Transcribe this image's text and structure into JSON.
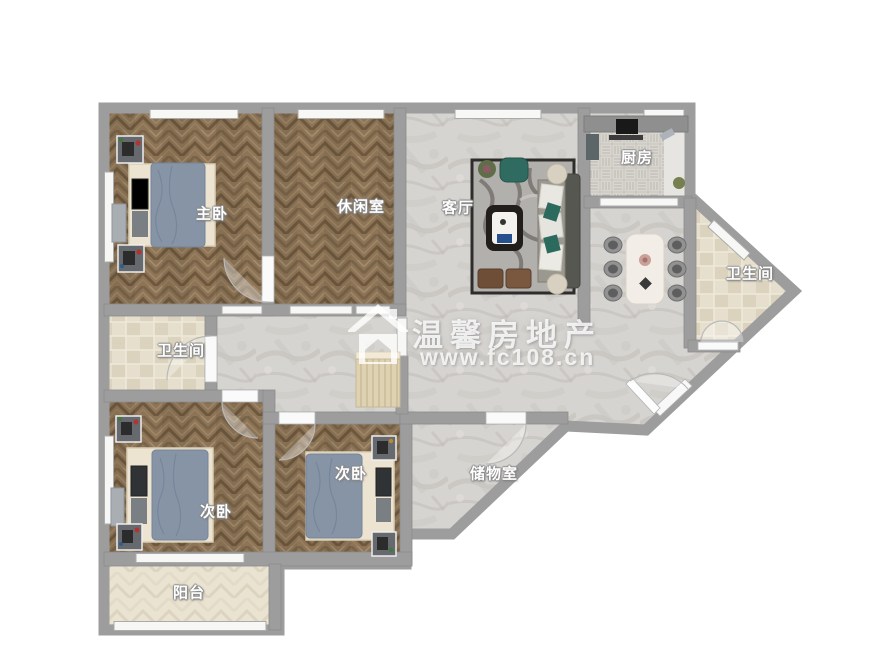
{
  "watermark": {
    "brand": "温馨房地产",
    "website": "www.fc108.cn",
    "logo_icon": "house-logo-icon"
  },
  "rooms": {
    "master_bedroom": {
      "label": "主卧"
    },
    "leisure_room": {
      "label": "休闲室"
    },
    "living_room": {
      "label": "客厅"
    },
    "kitchen": {
      "label": "厨房"
    },
    "bathroom_right": {
      "label": "卫生间"
    },
    "bathroom_left": {
      "label": "卫生间"
    },
    "second_bedroom_left": {
      "label": "次卧"
    },
    "second_bedroom_middle": {
      "label": "次卧"
    },
    "storage_room": {
      "label": "储物室"
    },
    "balcony": {
      "label": "阳台"
    }
  },
  "colors": {
    "wall": "#9d9d9d",
    "wood_floor": "#8d7457",
    "marble_floor": "#d6d4d0",
    "bath_tile": "#e3dcc9",
    "kitchen_tile": "#d9d6d0",
    "balcony_floor": "#eae3d2",
    "bed_duvet": "#8694a6",
    "sofa_accent": "#2f6b60",
    "watermark_text": "#ffffff"
  }
}
